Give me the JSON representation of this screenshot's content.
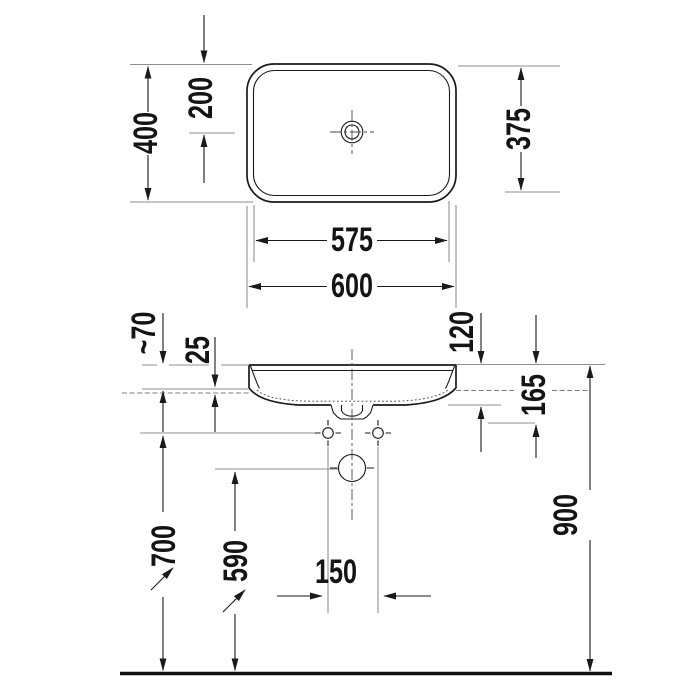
{
  "drawing": {
    "kind": "sanitary-ware installation technical drawing",
    "plan": {
      "overall_depth": "400",
      "tap_hole_from_rear": "200",
      "inner_depth": "375",
      "inner_width": "575",
      "overall_width": "600"
    },
    "elevation": {
      "rim_above_counter": "~70",
      "recess_depth": "25",
      "basin_height": "120",
      "outlet_from_rim": "165",
      "rim_height_from_floor": "900",
      "fixing_height_from_floor": "700",
      "outlet_height_from_floor": "590",
      "fixing_hole_spacing": "150"
    }
  }
}
